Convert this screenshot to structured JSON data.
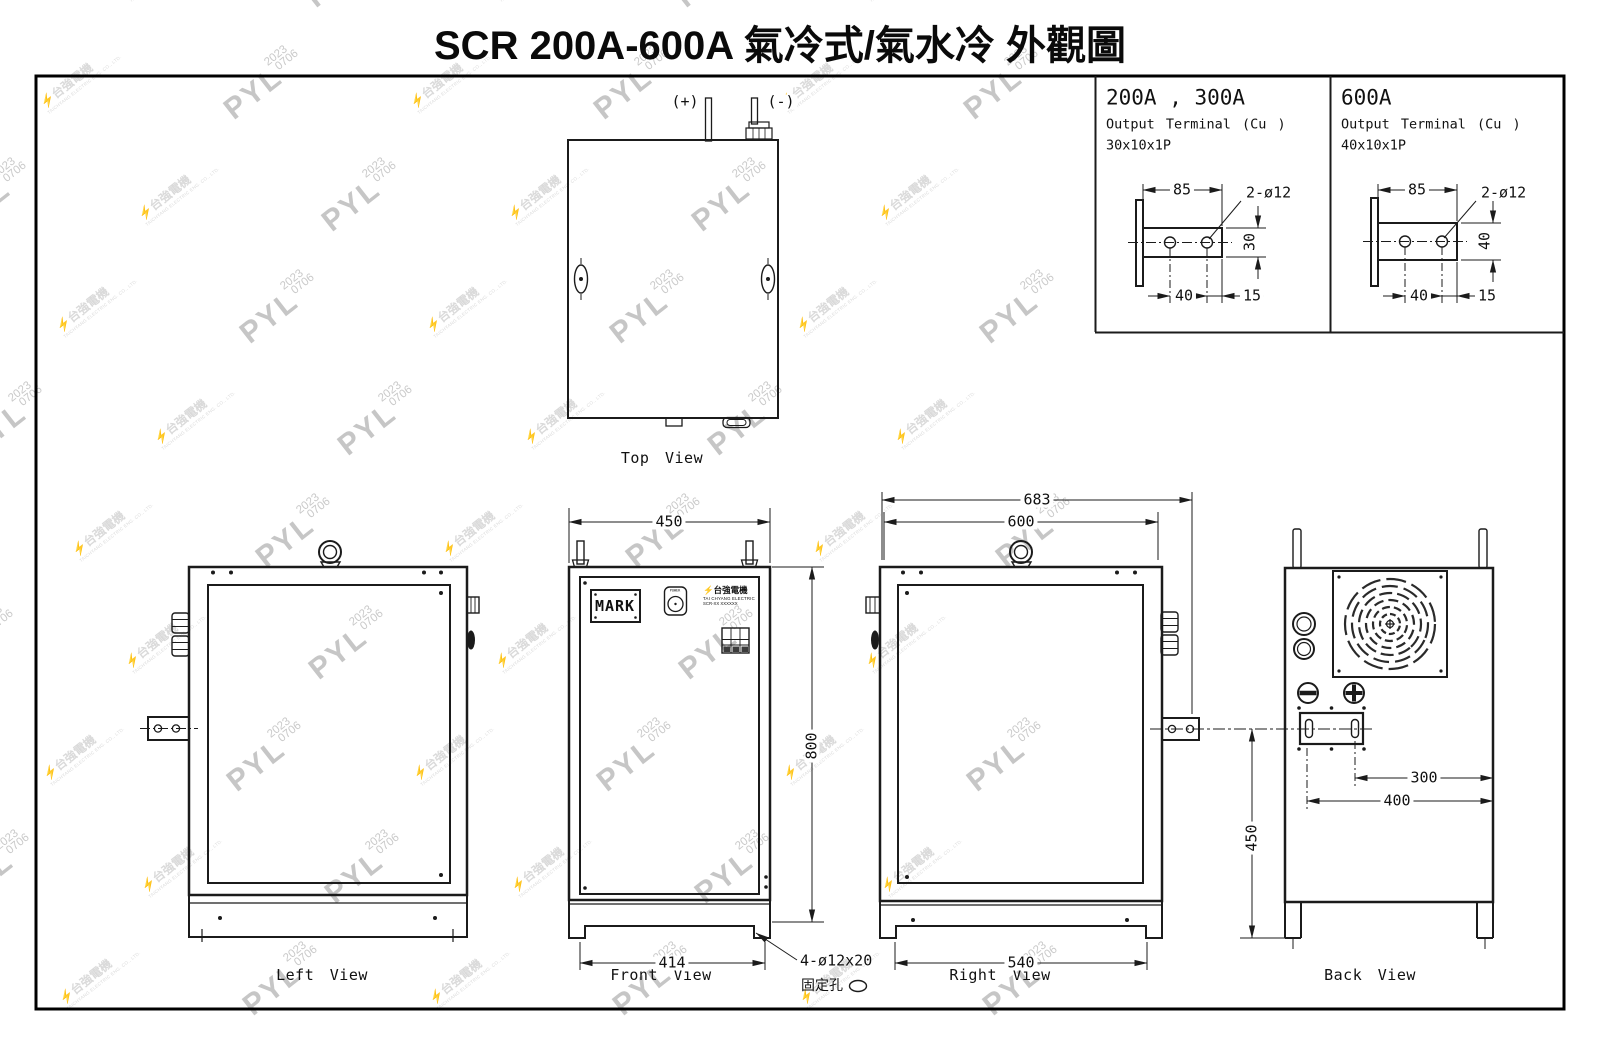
{
  "title": "SCR 200A-600A 氣冷式/氣水冷 外觀圖",
  "watermark": {
    "name": "PYL",
    "year": "2023",
    "date": "0706",
    "bolt": "⚡",
    "company_zh": "台強電機",
    "company_en": "TAICHYANG ELECTRIC ENG. CO., LTD."
  },
  "detail_boxes": [
    {
      "title": "200A , 300A",
      "subtitle": "Output Terminal (Cu )",
      "size": "30x10x1P",
      "dim_width": "85",
      "dim_holes": "2-ø12",
      "dim_height": "30",
      "dim_pitch": "40",
      "dim_end": "15"
    },
    {
      "title": "600A",
      "subtitle": "Output Terminal (Cu )",
      "size": "40x10x1P",
      "dim_width": "85",
      "dim_holes": "2-ø12",
      "dim_height": "40",
      "dim_pitch": "40",
      "dim_end": "15"
    }
  ],
  "top_view": {
    "label": "Top View",
    "plus": "(+)",
    "minus": "(-)"
  },
  "left_view": {
    "label": "Left View"
  },
  "front_view": {
    "label": "Front View",
    "dim_width": "450",
    "dim_height": "800",
    "dim_feet": "414",
    "mark": "MARK",
    "power": "POWER",
    "brand_zh": "⚡台強電機",
    "brand_en": "TAI CHYANG ELECTRIC",
    "model": "SCR-XX XXXXXX",
    "callout_line1": "4-ø12x20",
    "callout_line2": "固定孔"
  },
  "right_view": {
    "label": "Right View",
    "dim_overall": "683",
    "dim_width": "600",
    "dim_feet": "540"
  },
  "back_view": {
    "label": "Back View",
    "dim_terminal_offset": "300",
    "dim_plate_offset": "400",
    "dim_height": "450"
  }
}
